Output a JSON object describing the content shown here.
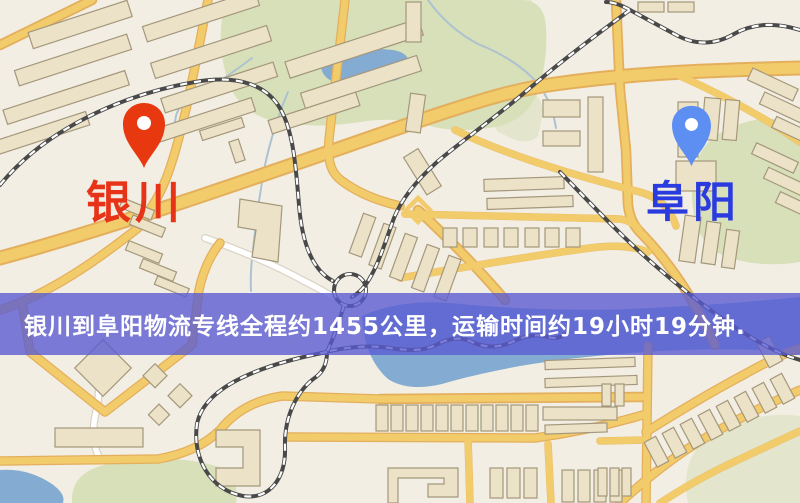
{
  "map": {
    "origin_marker": {
      "label": "银川",
      "pin_color": "#e8380f",
      "label_color": "#e73317"
    },
    "destination_marker": {
      "label": "阜阳",
      "pin_color": "#5d8ef2",
      "label_color": "#2a3be0"
    },
    "banner": {
      "text": "银川到阜阳物流专线全程约1455公里，运输时间约19小时19分钟."
    }
  },
  "colors": {
    "banner-bg": "#585ad2",
    "banner-text": "#ffffff",
    "map-bg": "#f2eee2",
    "road": "#f2c964",
    "road-edge": "#e3ab55",
    "white-road": "#ffffff",
    "white-road-edge": "#d9d2c2",
    "park": "#d5dfb6",
    "water": "#7ea7cf",
    "stream": "#a9bfce",
    "building": "#ebe1c4",
    "building-edge": "#a09275",
    "rail": "#404040"
  }
}
